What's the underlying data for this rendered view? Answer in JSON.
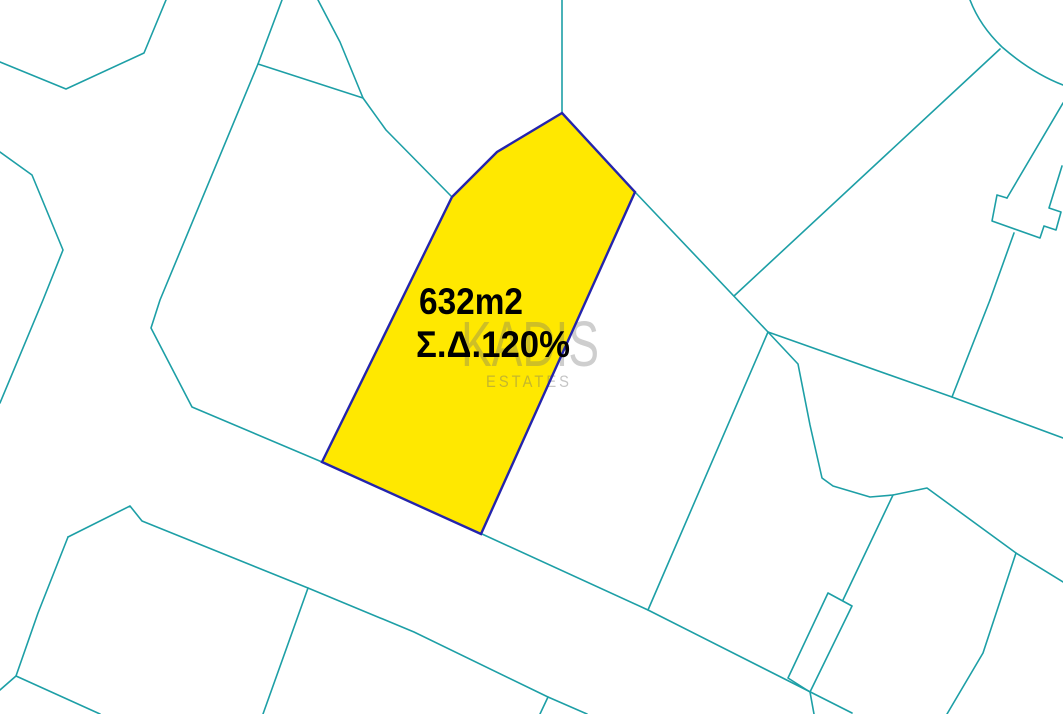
{
  "map": {
    "parcel": {
      "area_label": "632m2",
      "density_label": "Σ.Δ.120%"
    },
    "watermark": {
      "title": "KADIS",
      "subtitle": "ESTATES"
    }
  },
  "colors": {
    "background": "#ffffff",
    "boundary-line": "#1d9fa6",
    "parcel-fill": "#ffe800",
    "parcel-border": "#2424ad",
    "label-text": "#000000",
    "watermark-text": "#6e6e6e"
  }
}
